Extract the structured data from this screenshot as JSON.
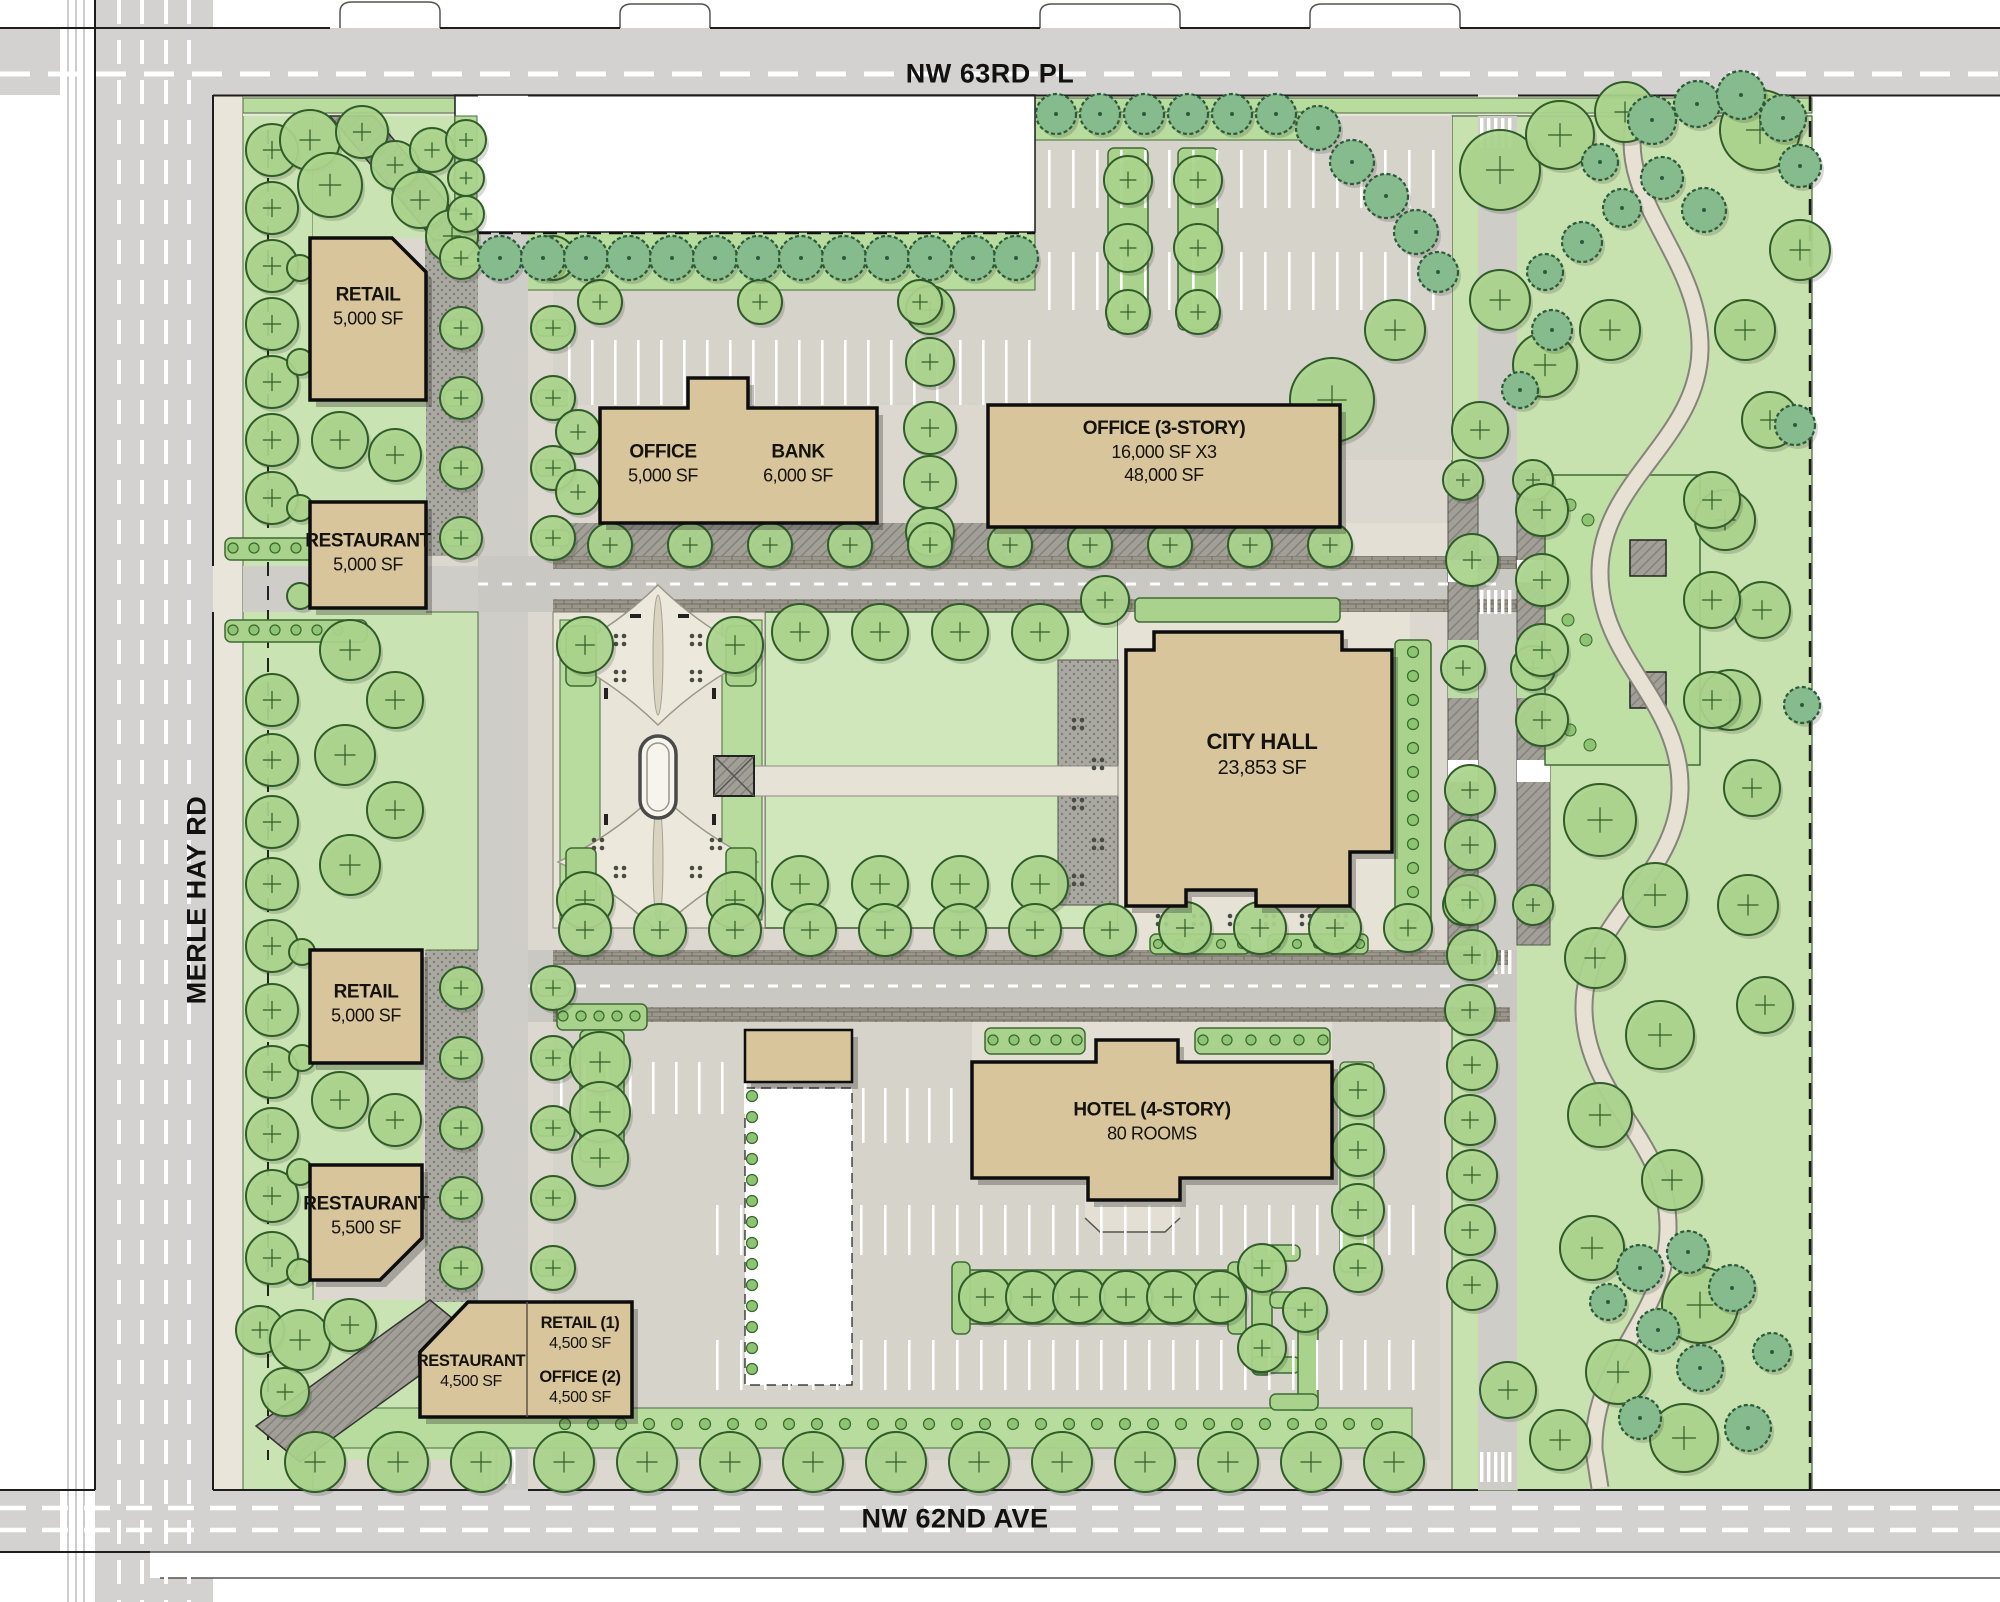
{
  "plan_title": "City Hall mixed-use development site plan",
  "roads": {
    "top": "NW 63RD PL",
    "left": "MERLE HAY RD",
    "bottom": "NW 62ND AVE"
  },
  "buildings": [
    {
      "name": "RETAIL",
      "size": "5,000 SF"
    },
    {
      "name": "RESTAURANT",
      "size": "5,000 SF"
    },
    {
      "name": "OFFICE",
      "size": "5,000 SF"
    },
    {
      "name": "BANK",
      "size": "6,000 SF"
    },
    {
      "name": "OFFICE (3-STORY)",
      "size": "16,000 SF X3",
      "size2": "48,000 SF"
    },
    {
      "name": "CITY HALL",
      "size": "23,853 SF"
    },
    {
      "name": "RETAIL",
      "size": "5,000 SF"
    },
    {
      "name": "RESTAURANT",
      "size": "5,500 SF"
    },
    {
      "name": "RESTAURANT",
      "size": "4,500 SF"
    },
    {
      "name": "RETAIL (1)",
      "size": "4,500 SF"
    },
    {
      "name": "OFFICE (2)",
      "size": "4,500 SF"
    },
    {
      "name": "HOTEL (4-STORY)",
      "size": "80 ROOMS"
    }
  ],
  "colors": {
    "building": "#d8c59c",
    "lawn": "#c9e4b2",
    "road": "#d3d2d0",
    "tree": "#abd58d",
    "evergreen": "#86bb8d"
  }
}
